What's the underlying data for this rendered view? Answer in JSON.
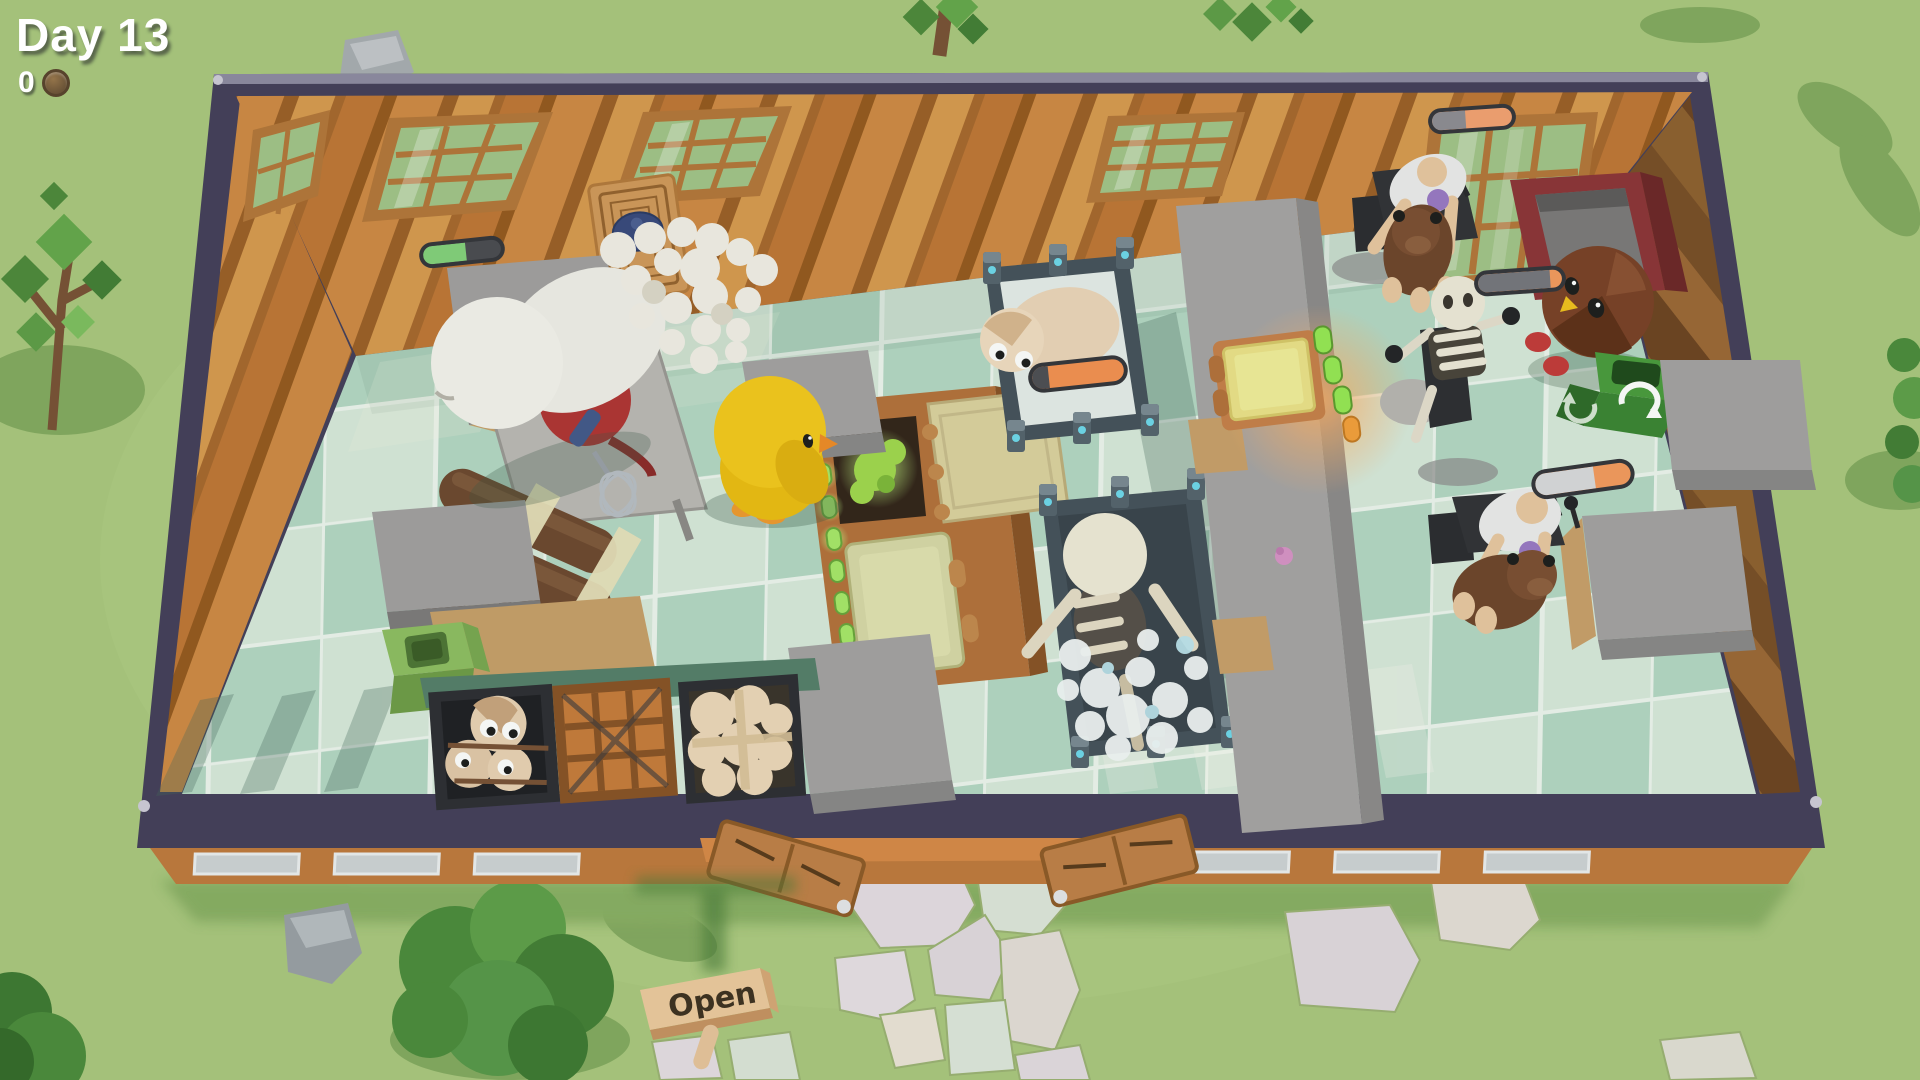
{
  "hud": {
    "day_label": "Day 13",
    "coin_count": "0",
    "coin_icon": "coin-icon"
  },
  "open_sign": {
    "label": "Open"
  },
  "progress_bars": {
    "prep": {
      "left_percent": 55,
      "left_color": "#84d17c",
      "right_color": "#4b4b52"
    },
    "wash": {
      "left_percent": 18,
      "left_color": "#4e4e55",
      "right_color": "#f59152"
    },
    "dining_top": {
      "left_percent": 42,
      "left_color": "#8f8d94",
      "right_color": "#f5a272"
    },
    "bird_order": {
      "left_percent": 86,
      "left_color": "#77767e",
      "right_color": "#f59a5e"
    },
    "dining_bottom": {
      "left_percent": 62,
      "left_color": "#dadadd",
      "right_color": "#f59a5e"
    }
  },
  "characters": [
    "white-chef",
    "yellow-chick",
    "dough-sheep",
    "skeleton-bathing",
    "skeleton-customer",
    "human-customer-top",
    "human-customer-bottom",
    "brown-bird",
    "pet-dog-top",
    "pet-dog-bottom",
    "sheep-in-crate"
  ],
  "stations": [
    "mixing-machine",
    "prep-table",
    "wooden-oven",
    "serving-counter",
    "counter-oven-hatch",
    "wash-station-sheep",
    "wash-station-skeleton",
    "chocolate-log-stack",
    "compost-bin",
    "recycle-bin",
    "sheep-crate",
    "empty-crate",
    "dough-crate",
    "display-machine"
  ],
  "props": [
    "bone",
    "chopping-board",
    "whisk",
    "meringue-pile",
    "purple-muffin",
    "pink-muffin-dropped",
    "open-sign",
    "stepping-stones",
    "trees",
    "rocks"
  ],
  "colors": {
    "grass": "#abc87f",
    "tile_light": "#d8e9dc",
    "tile_dark": "#b5d7c5",
    "wall_trim": "#453f5b",
    "wall_wood": "#c9823f",
    "accent_orange": "#f59a5e",
    "accent_green": "#84d17c",
    "oven_glow": "#f2e88a"
  }
}
